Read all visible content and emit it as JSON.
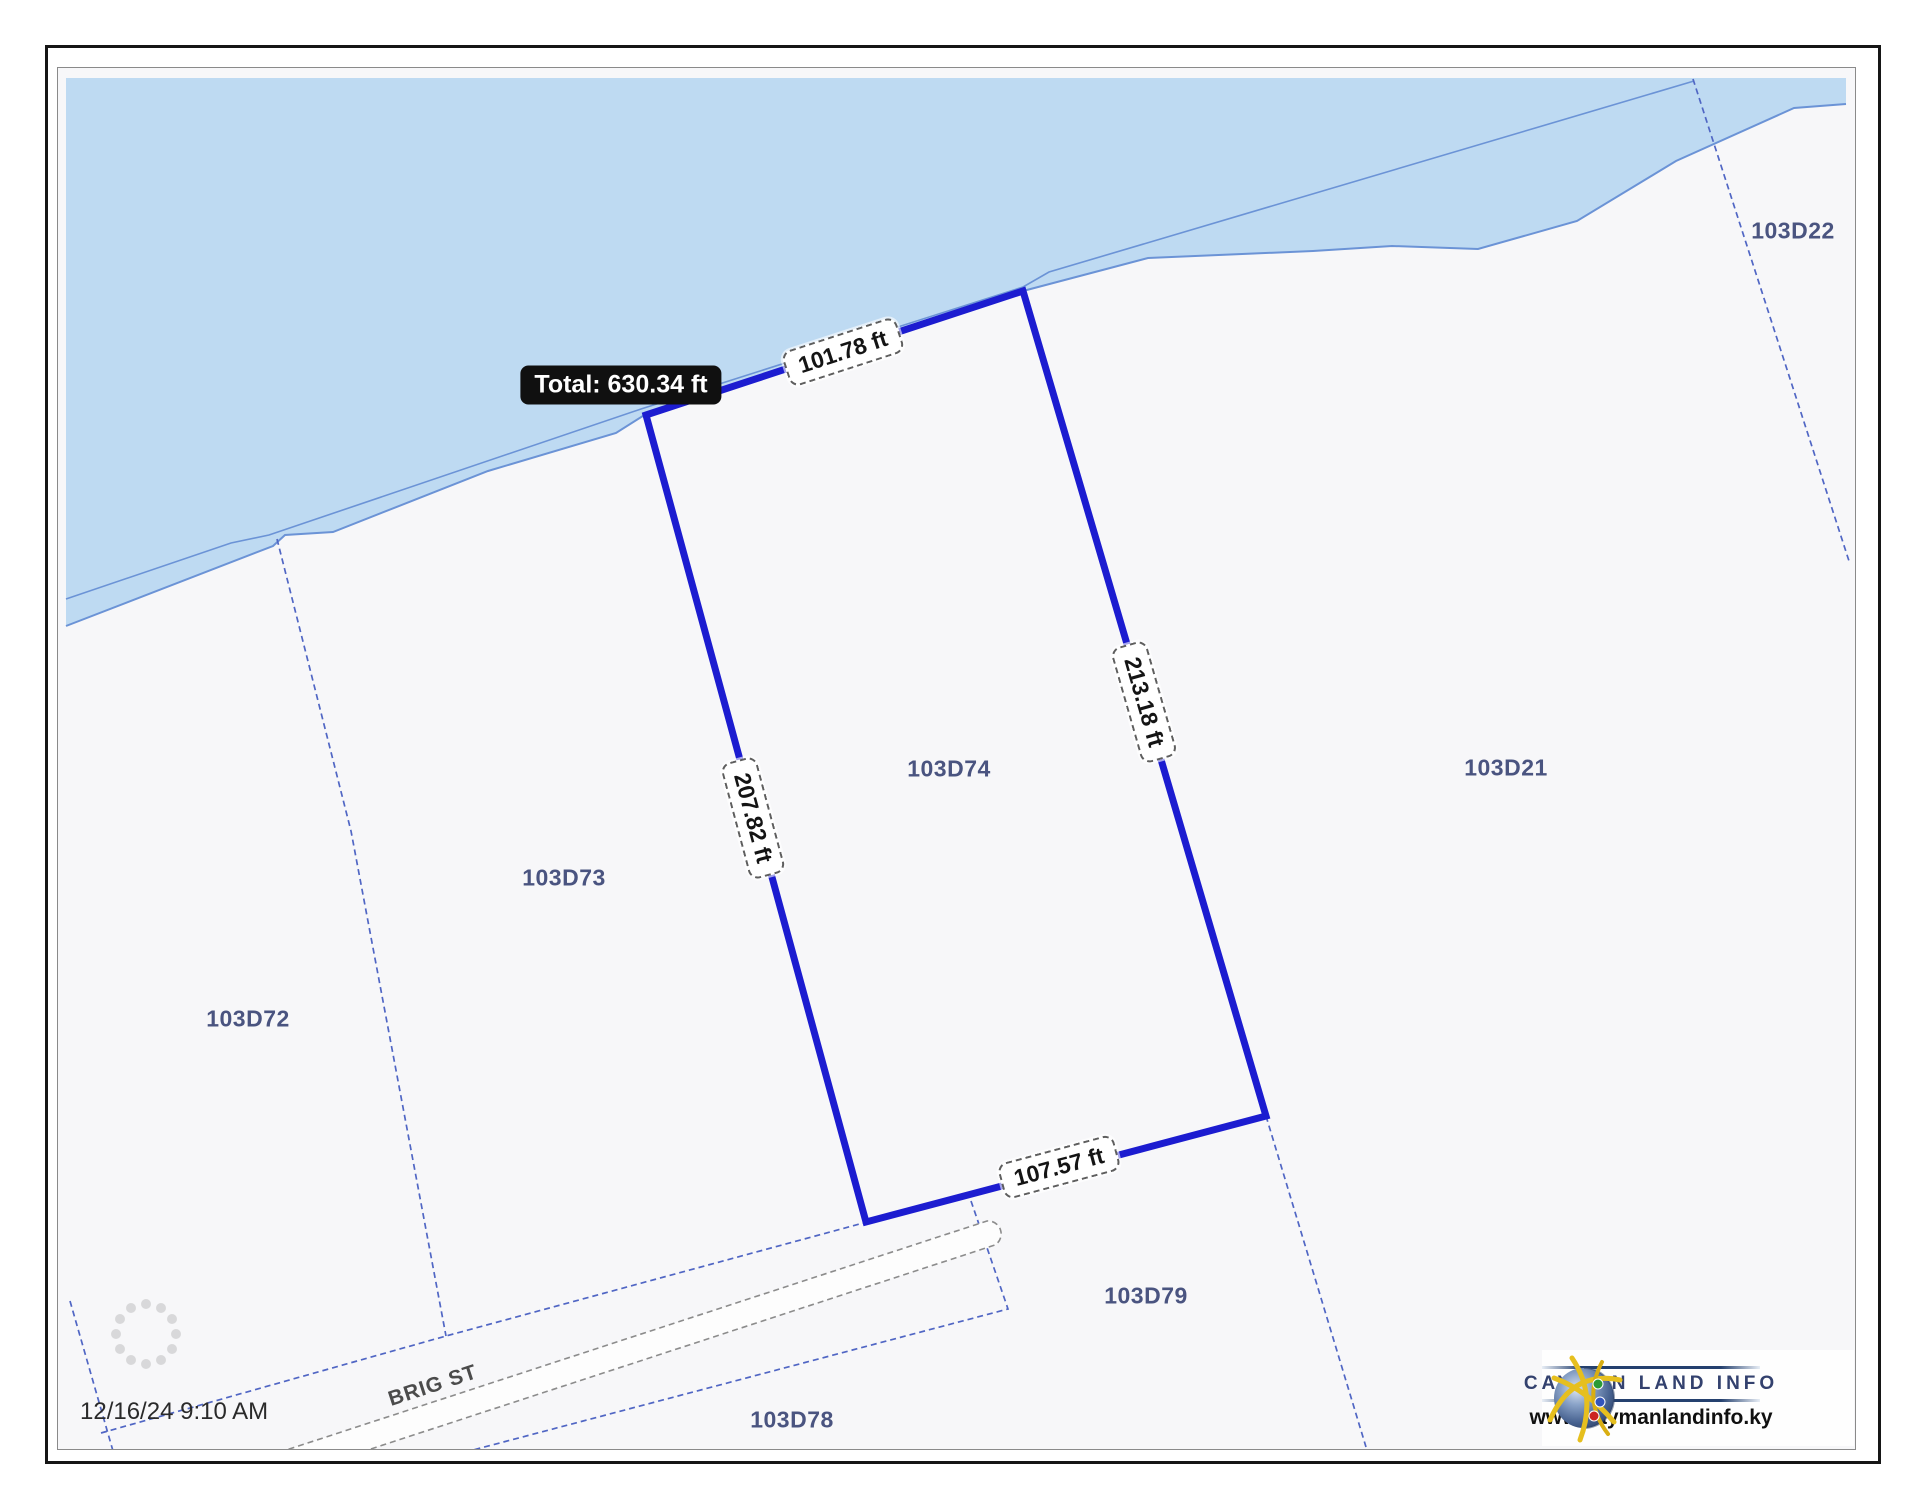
{
  "map": {
    "timestamp": "12/16/24 9:10 AM",
    "street_label": "BRIG ST",
    "total_tooltip": "Total: 630.34 ft",
    "parcels": [
      {
        "id": "103D72"
      },
      {
        "id": "103D73"
      },
      {
        "id": "103D74"
      },
      {
        "id": "103D21"
      },
      {
        "id": "103D22"
      },
      {
        "id": "103D79"
      },
      {
        "id": "103D78"
      }
    ],
    "measurements": [
      {
        "side": "north",
        "value": "101.78 ft"
      },
      {
        "side": "east",
        "value": "213.18 ft"
      },
      {
        "side": "west",
        "value": "207.82 ft"
      },
      {
        "side": "south",
        "value": "107.57 ft"
      }
    ],
    "colors": {
      "water": "#bedaf2",
      "shoreline": "#6b93d6",
      "parcel_line": "#5066c4",
      "measured_line": "#1c1cd0",
      "parcel_label": "#4a5480",
      "land": "#f7f7f9"
    }
  },
  "branding": {
    "name": "CAYMAN LAND INFO",
    "url": "www.caymanlandinfo.ky"
  }
}
